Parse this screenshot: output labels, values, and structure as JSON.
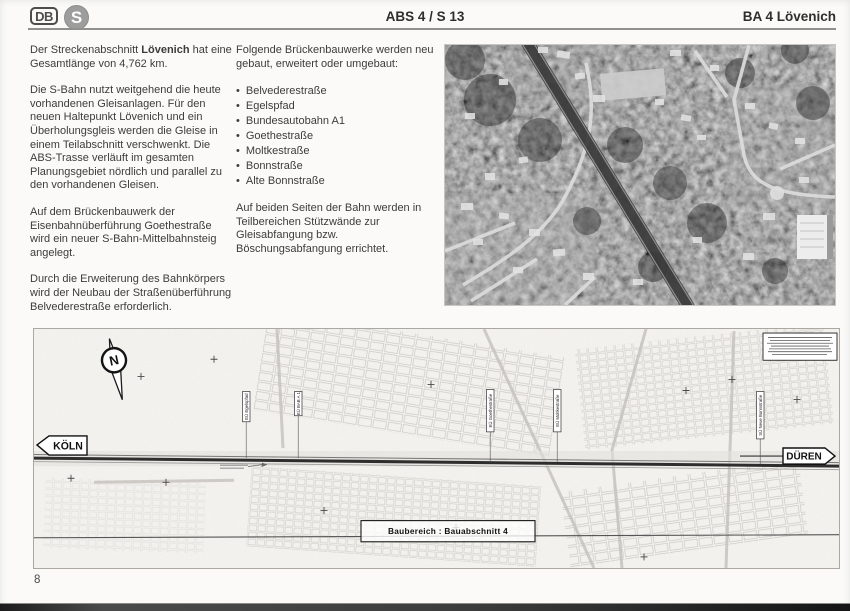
{
  "header": {
    "db_logo_text": "DB",
    "sbahn_logo_text": "S",
    "center_title": "ABS 4 / S 13",
    "right_title": "BA 4 Lövenich"
  },
  "text": {
    "left": {
      "p1_pre": "Der Streckenabschnitt ",
      "p1_bold": "Lövenich",
      "p1_post": " hat eine Gesamtlänge von 4,762 km.",
      "p2": "Die S-Bahn nutzt weitgehend die heute vorhandenen Gleisanlagen. Für den neuen Haltepunkt Lövenich und ein Überholungsgleis werden die Gleise in einem Teilabschnitt verschwenkt. Die ABS-Trasse verläuft im gesamten Planungsgebiet nördlich und parallel zu den vorhandenen Gleisen.",
      "p3": "Auf dem Brückenbauwerk der Eisenbahnüberführung Goethestraße wird ein neuer S-Bahn-Mittelbahnsteig angelegt.",
      "p4": "Durch die Erweiterung des Bahnkörpers wird der Neubau der Straßenüberführung Belvederestraße erforderlich."
    },
    "middle": {
      "intro": "Folgende Brückenbauwerke werden neu gebaut, erweitert oder umgebaut:",
      "bullets": [
        "Belvederestraße",
        "Egelspfad",
        "Bundesautobahn A1",
        "Goethestraße",
        "Moltkestraße",
        "Bonnstraße",
        "Alte Bonnstraße"
      ],
      "outro": "Auf beiden Seiten der Bahn werden in Teilbereichen Stützwände zur Gleisabfangung bzw. Böschungsabfangung errichtet."
    }
  },
  "map": {
    "north_label": "N",
    "left_sign": "KÖLN",
    "right_sign": "DÜREN",
    "area_label": "Baubereich : Bauabschnitt 4",
    "bridge_labels": [
      "EÜ Egelspfad",
      "EÜ BAB A 1",
      "EÜ Goethestraße",
      "EÜ Moltkestraße",
      "SÜ Neue Bonnstraße"
    ]
  },
  "page": {
    "number": "8"
  },
  "colors": {
    "page_bg": "#fbfaf8",
    "ink": "#3c3c3c",
    "rail_line": "#2e2e2e"
  }
}
